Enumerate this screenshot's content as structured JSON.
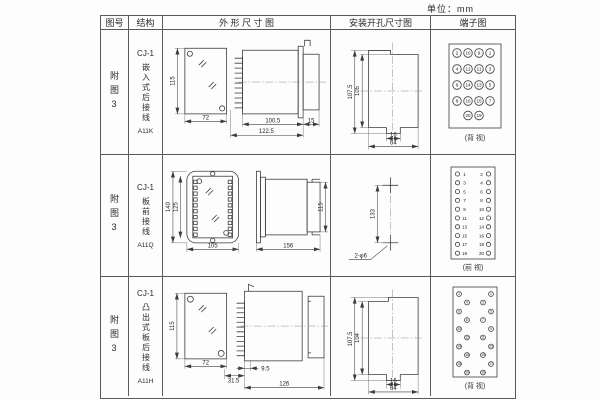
{
  "unit_label": "单位：mm",
  "table": {
    "headers": [
      "图号",
      "结构",
      "外 形 尺 寸 图",
      "安装开孔尺寸图",
      "端子图"
    ]
  },
  "rows": [
    {
      "fig_no": "附图3",
      "structure": {
        "model": "CJ-1",
        "desc": "嵌入式后接线",
        "code": "A11K"
      },
      "outline": {
        "front_h": "115",
        "front_w": "72",
        "d1": "100.5",
        "d2": "122.5",
        "d3": "15"
      },
      "install": {
        "v1": "107.5",
        "v2": "105",
        "h1": "16",
        "h2": "64"
      },
      "terminal": {
        "view": "(背 视)",
        "grid": [
          [
            "2",
            "10",
            "9",
            "1"
          ],
          [
            "4",
            "12",
            "11",
            "3"
          ],
          [
            "6",
            "14",
            "13",
            "5"
          ],
          [
            "8",
            "16",
            "15",
            "7"
          ]
        ],
        "bottom": [
          "20",
          "19"
        ]
      }
    },
    {
      "fig_no": "附图3",
      "structure": {
        "model": "CJ-1",
        "desc": "板前接线",
        "code": "A11Q"
      },
      "outline": {
        "v1": "140",
        "v2": "125",
        "h1": "105",
        "d1": "156",
        "d2": "115"
      },
      "install": {
        "v1": "133",
        "hole": "2-φ6"
      },
      "terminal": {
        "view": "(前 视)",
        "pairs": [
          [
            "1",
            "2"
          ],
          [
            "3",
            "4"
          ],
          [
            "5",
            "6"
          ],
          [
            "7",
            "8"
          ],
          [
            "9",
            "10"
          ],
          [
            "11",
            "12"
          ],
          [
            "13",
            "14"
          ],
          [
            "15",
            "16"
          ],
          [
            "17",
            "18"
          ],
          [
            "19",
            "20"
          ]
        ]
      }
    },
    {
      "fig_no": "附图3",
      "structure": {
        "model": "CJ-1",
        "desc": "凸出式板后接线",
        "code": "A11H"
      },
      "outline": {
        "front_h": "115",
        "front_w": "72",
        "d1": "31.5",
        "d2": "9.5",
        "d3": "126"
      },
      "install": {
        "v1": "107.5",
        "v2": "104",
        "h1": "16",
        "h2": "64"
      },
      "terminal": {
        "view": "(背 视)",
        "cols": {
          "left_outer": [
            "2",
            "6",
            "10",
            "14",
            "18"
          ],
          "left_inner": [
            "4",
            "8",
            "12",
            "16",
            "20"
          ],
          "right_inner": [
            "3",
            "7",
            "11",
            "15",
            "19"
          ],
          "right_outer": [
            "1",
            "5",
            "9",
            "13",
            "17"
          ]
        }
      }
    }
  ]
}
